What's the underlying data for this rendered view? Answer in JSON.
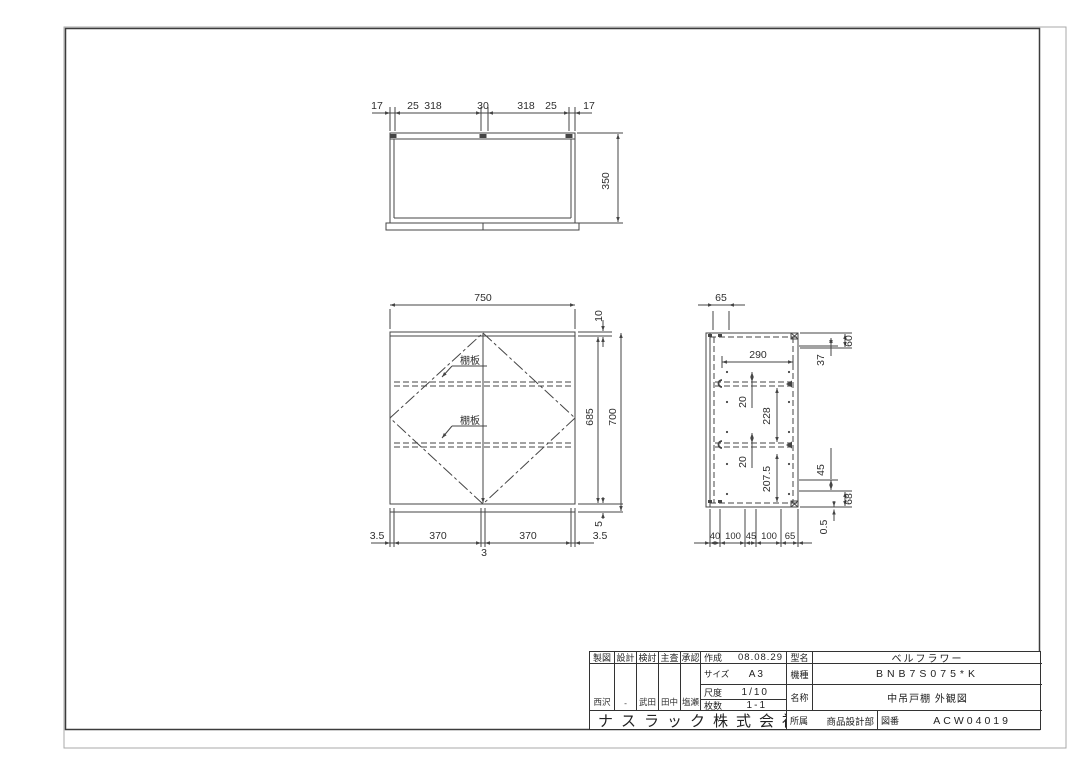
{
  "top_view": {
    "dims_top": [
      "17",
      "25",
      "318",
      "30",
      "318",
      "25",
      "17"
    ],
    "dim_height": "350"
  },
  "front_view": {
    "dim_width": "750",
    "dim_top": "10",
    "dim_body": "685",
    "dim_total": "700",
    "dim_bottom": "5",
    "dims_bottom": [
      "3.5",
      "370",
      "370",
      "3.5"
    ],
    "dim_center": "3",
    "shelf_label_1": "棚板",
    "shelf_label_2": "棚板"
  },
  "side_view": {
    "dim_top": "65",
    "dim_inner_width": "290",
    "dim_gap_1": "20",
    "dim_gap_2": "20",
    "dim_span_1": "228",
    "dim_span_2": "207.5",
    "dim_r_60": "60",
    "dim_r_37": "37",
    "dim_r_45": "45",
    "dim_r_68": "68",
    "dim_r_05": "0.5",
    "dims_bottom": [
      "40",
      "100",
      "45",
      "100",
      "65"
    ]
  },
  "title_block": {
    "approval_headers": [
      "製図",
      "設計",
      "検討",
      "主査",
      "承認"
    ],
    "approval_names": [
      "西沢",
      "-",
      "武田",
      "田中",
      "塩瀬"
    ],
    "created_label": "作成",
    "created_value": "08.08.29",
    "size_label": "サイズ",
    "size_value": "A3",
    "scale_label": "尺度",
    "scale_value": "1/10",
    "sheets_label": "枚数",
    "sheets_value": "1-1",
    "model_label": "型名",
    "model_value": "ベルフラワー",
    "machine_label": "機種",
    "machine_value": "BNB7S075*K",
    "name_label": "名称",
    "name_value": "中吊戸棚 外観図",
    "company": "ナスラック株式会社",
    "dept_label": "所属",
    "dept_value": "商品設計部",
    "dwg_label": "図番",
    "dwg_value": "ACW04019"
  }
}
